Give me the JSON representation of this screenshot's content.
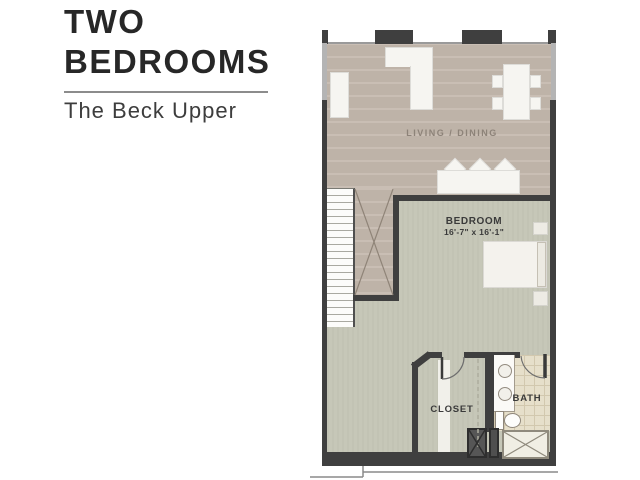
{
  "panel": {
    "title_line1": "TWO",
    "title_line2": "BEDROOMS",
    "subtitle": "The Beck Upper"
  },
  "floorplan": {
    "rooms": {
      "living_label": "LIVING / DINING",
      "bedroom_label": "BEDROOM",
      "bedroom_dimensions": "16'-7\" x 16'-1\"",
      "closet_label": "CLOSET",
      "bath_label": "BATH"
    },
    "colors": {
      "wall": "#3f3f3f",
      "wood_floor": "#c3b7ac",
      "carpet": "#c6c7b8",
      "tile": "#e6dfca",
      "window": "#b4b4b4",
      "furniture": "#f6f5f1",
      "label_text": "#3a3a3a",
      "living_label_text": "#8d8379"
    }
  }
}
